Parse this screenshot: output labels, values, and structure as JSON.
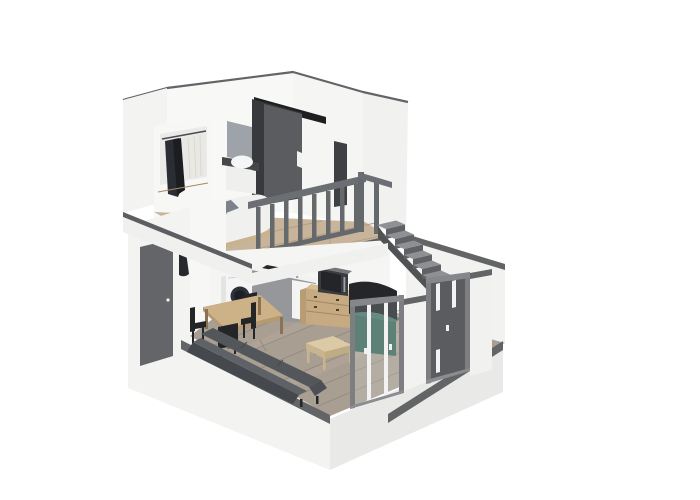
{
  "scene": {
    "description": "3D axonometric cutaway rendering of a two-level studio loft apartment on a white background",
    "view": "isometric cutaway, no text or UI controls visible",
    "levels": [
      {
        "name": "mezzanine",
        "features": [
          "open wardrobe with hanging dark and light clothes",
          "vanity with grey mirror and white washbasin",
          "double bed with white duvet and grey pillows",
          "dark grey sliding door",
          "narrow dark wall panel",
          "grey guard railing with balusters",
          "light wood plank floor",
          "staircase leading down"
        ]
      },
      {
        "name": "ground-floor",
        "features": [
          "dark grey entry door in left wall",
          "coat hook with hanging jacket",
          "white washing machine with round dark door",
          "grey kitchen counter with dark cooktop and white tall panel",
          "light wood dresser with microwave on top",
          "dark curved television on dark green cabinet",
          "wood dining table with dark chairs",
          "dark grey sofa",
          "light wood coffee table",
          "two folding glass partition doors with grey frames",
          "taupe wood plank floor",
          "white floor slab base"
        ]
      }
    ]
  },
  "colors": {
    "bg": "#ffffff",
    "wallLight": "#f3f3f2",
    "wallInterior": "#f8f8f7",
    "wallInterior2": "#f5f5f4",
    "wallExterior": "#f1f1f0",
    "wallB": "#f2f2f1",
    "strip": "#626466",
    "floorEdge": "#5c5e61",
    "fascia": "#f0f0ef",
    "mezzFloor": "#c7b49a",
    "mezzSeam": "#b19e85",
    "duvet": "#f0f0ef",
    "pillow1": "#8d939c",
    "pillow2": "#7b828c",
    "bedFrame": "#c9b28e",
    "wardrobe": "#f7f7f6",
    "wardrobeInner": "#eaeae9",
    "rod": "#4a4c4e",
    "clothesDark": "#2a2d33",
    "clothesDarker": "#1b1d21",
    "clothesLight": "#eae8e3",
    "clothesSeam": "#d7d5d0",
    "mirror": "#9da3a8",
    "vanityCounter": "#45474a",
    "sink": "#f5f6f6",
    "vanityCabinet": "#efefee",
    "wedge": "#1e1f21",
    "doorBack": "#37393c",
    "slidingDoor": "#5a5c5f",
    "handleWhite": "#f1f1f0",
    "darkPanel": "#3e4043",
    "railing": "#66696c",
    "railingRail": "#6b6e72",
    "stairTread": "#8e9093",
    "stairRiser": "#5f6164",
    "stairStringer": "#505254",
    "floor": "#a89e91",
    "floorSeam": "#948a7e",
    "floorLightPlank": "#b2a89b",
    "slabRight": "#e9e9e8",
    "entryDoor": "#636568",
    "jacket": "#26282b",
    "washer": "#f5f5f5",
    "washerSide": "#e4e4e3",
    "washerDoor": "#2e313b",
    "washerDoorInner": "#1d1f26",
    "washerTrim": "#cfcfce",
    "counterFront": "#96979a",
    "counterTop": "#f2f2f1",
    "cooktop": "#26282b",
    "whitePanel": "#f4f4f3",
    "dresser": "#c6ab82",
    "dresserTop": "#d6bd93",
    "dresserSide": "#b89d74",
    "drawerLine": "#a5895f",
    "knob": "#4a3f30",
    "microwave": "#3a3c3f",
    "microwaveTop": "#74767a",
    "microwaveDoor": "#232528",
    "green": "#3b675a",
    "greenTop": "#447365",
    "tv": "#242628",
    "tableTop": "#cdb187",
    "tableEdge": "#b59a71",
    "tableLeg": "#8a7354",
    "chair": "#232527",
    "sofaBack": "#45484c",
    "sofaTop": "#5e6166",
    "sofaSeat": "#53565a",
    "sofaArm": "#4c4f53",
    "coffeeTop": "#dcc9a5",
    "coffeeSide": "#c8b48e",
    "coffeeSideR": "#bfab84",
    "coffeeShadow": "#6b6257",
    "doorFrame": "#7c7e81",
    "doorFrameTop": "#85878a",
    "doorSill": "#8a8c8f",
    "mullion": "#f2f2f2",
    "glass": "#e8eae9",
    "diningWall": "#f7f7f6",
    "kitchenWall": "#f5f5f4"
  }
}
